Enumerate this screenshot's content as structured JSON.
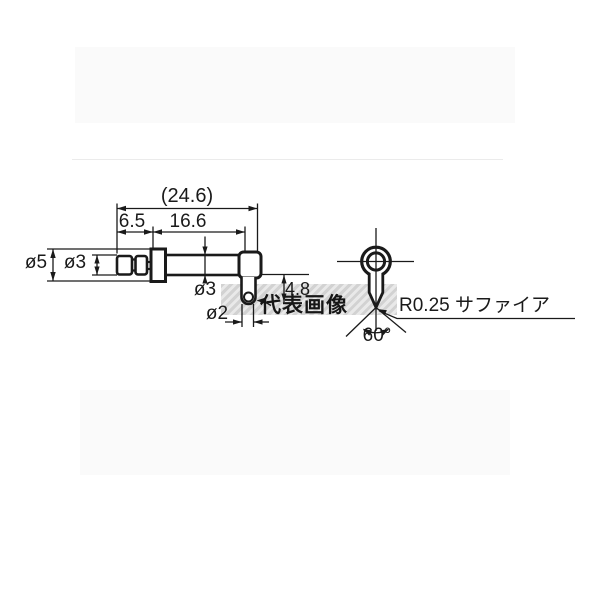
{
  "page": {
    "background": "#ffffff"
  },
  "diagram": {
    "type": "technical-drawing",
    "line_color": "#1a1a1a",
    "side_view": {
      "description": "probe stylus side view",
      "dims": {
        "overall_length": "(24.6)",
        "rear_length": "6.5",
        "shaft_length": "16.6",
        "flange_diameter": "ø5",
        "plug_diameter": "ø3",
        "shaft_diameter": "ø3",
        "tip_stem_diameter": "ø2",
        "tip_drop_length": "4.8"
      }
    },
    "front_view": {
      "description": "stylus tip front view",
      "dims": {
        "tip_angle": "60°"
      },
      "tip_material_note": "R0.25 サファイア"
    },
    "watermark": {
      "text": "代表画像",
      "band_color": "#d6d6d6",
      "band_stripe_color": "#e9e9e9"
    }
  }
}
